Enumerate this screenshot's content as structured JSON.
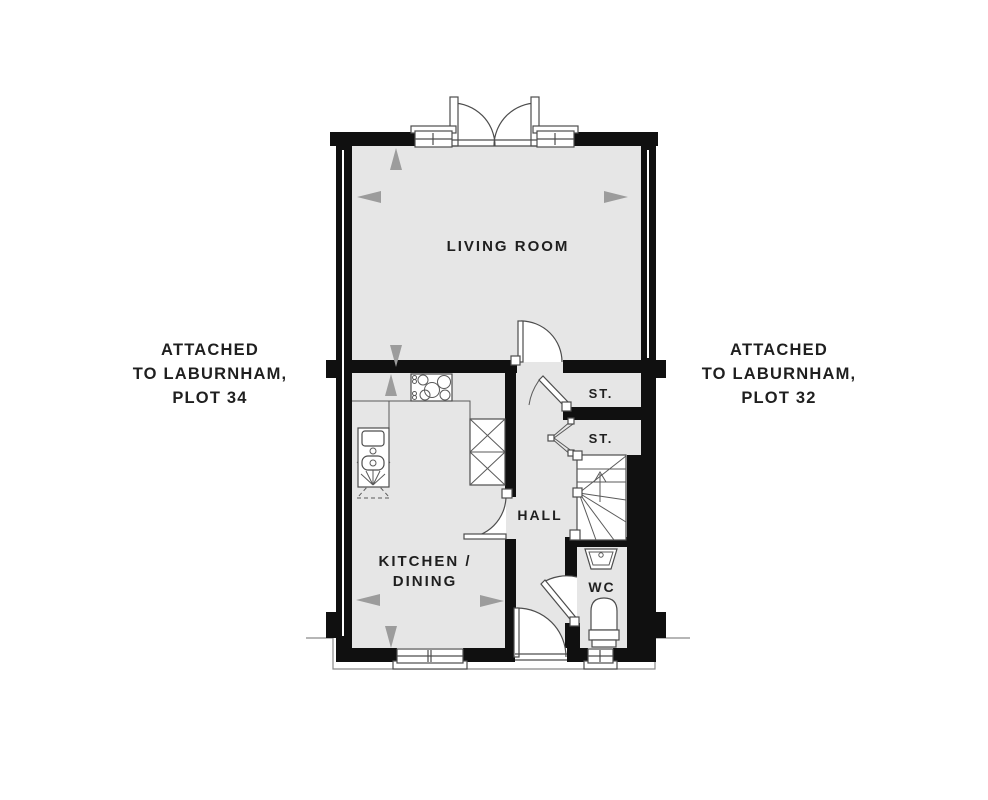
{
  "canvas": {
    "width": 988,
    "height": 800
  },
  "colors": {
    "wall": "#101010",
    "floor_fill": "#e6e6e6",
    "fixture_line": "#4d4d4d",
    "dimension_arrow": "#9c9c9c",
    "text": "#1f1f1f",
    "neighbor_outline": "#8a8a8a",
    "background": "#ffffff"
  },
  "plan": {
    "rooms": {
      "living": {
        "label": "LIVING ROOM"
      },
      "kitchen": {
        "label_line1": "KITCHEN /",
        "label_line2": "DINING"
      },
      "hall": {
        "label": "HALL"
      },
      "storage_top": {
        "label": "ST."
      },
      "storage_bottom": {
        "label": "ST."
      },
      "wc": {
        "label": "WC"
      }
    },
    "fixtures": {
      "french_doors": "double outward-opening doors, top wall",
      "windows": "top wall x2, kitchen bottom, wc bottom",
      "hob": "5-ring cooktop on kitchen top counter",
      "kitchen_sink": "double bowl sink with drainer, left wall",
      "appliance_unit": "two stacked cross-marked units",
      "staircase": "winder stair with up arrow",
      "wash_basin": "corner basin in wc",
      "toilet": "toilet against bottom wall of wc"
    }
  },
  "annotations": {
    "left": {
      "line1": "ATTACHED",
      "line2": "TO LABURNHAM,",
      "line3": "PLOT 34"
    },
    "right": {
      "line1": "ATTACHED",
      "line2": "TO LABURNHAM,",
      "line3": "PLOT 32"
    }
  }
}
